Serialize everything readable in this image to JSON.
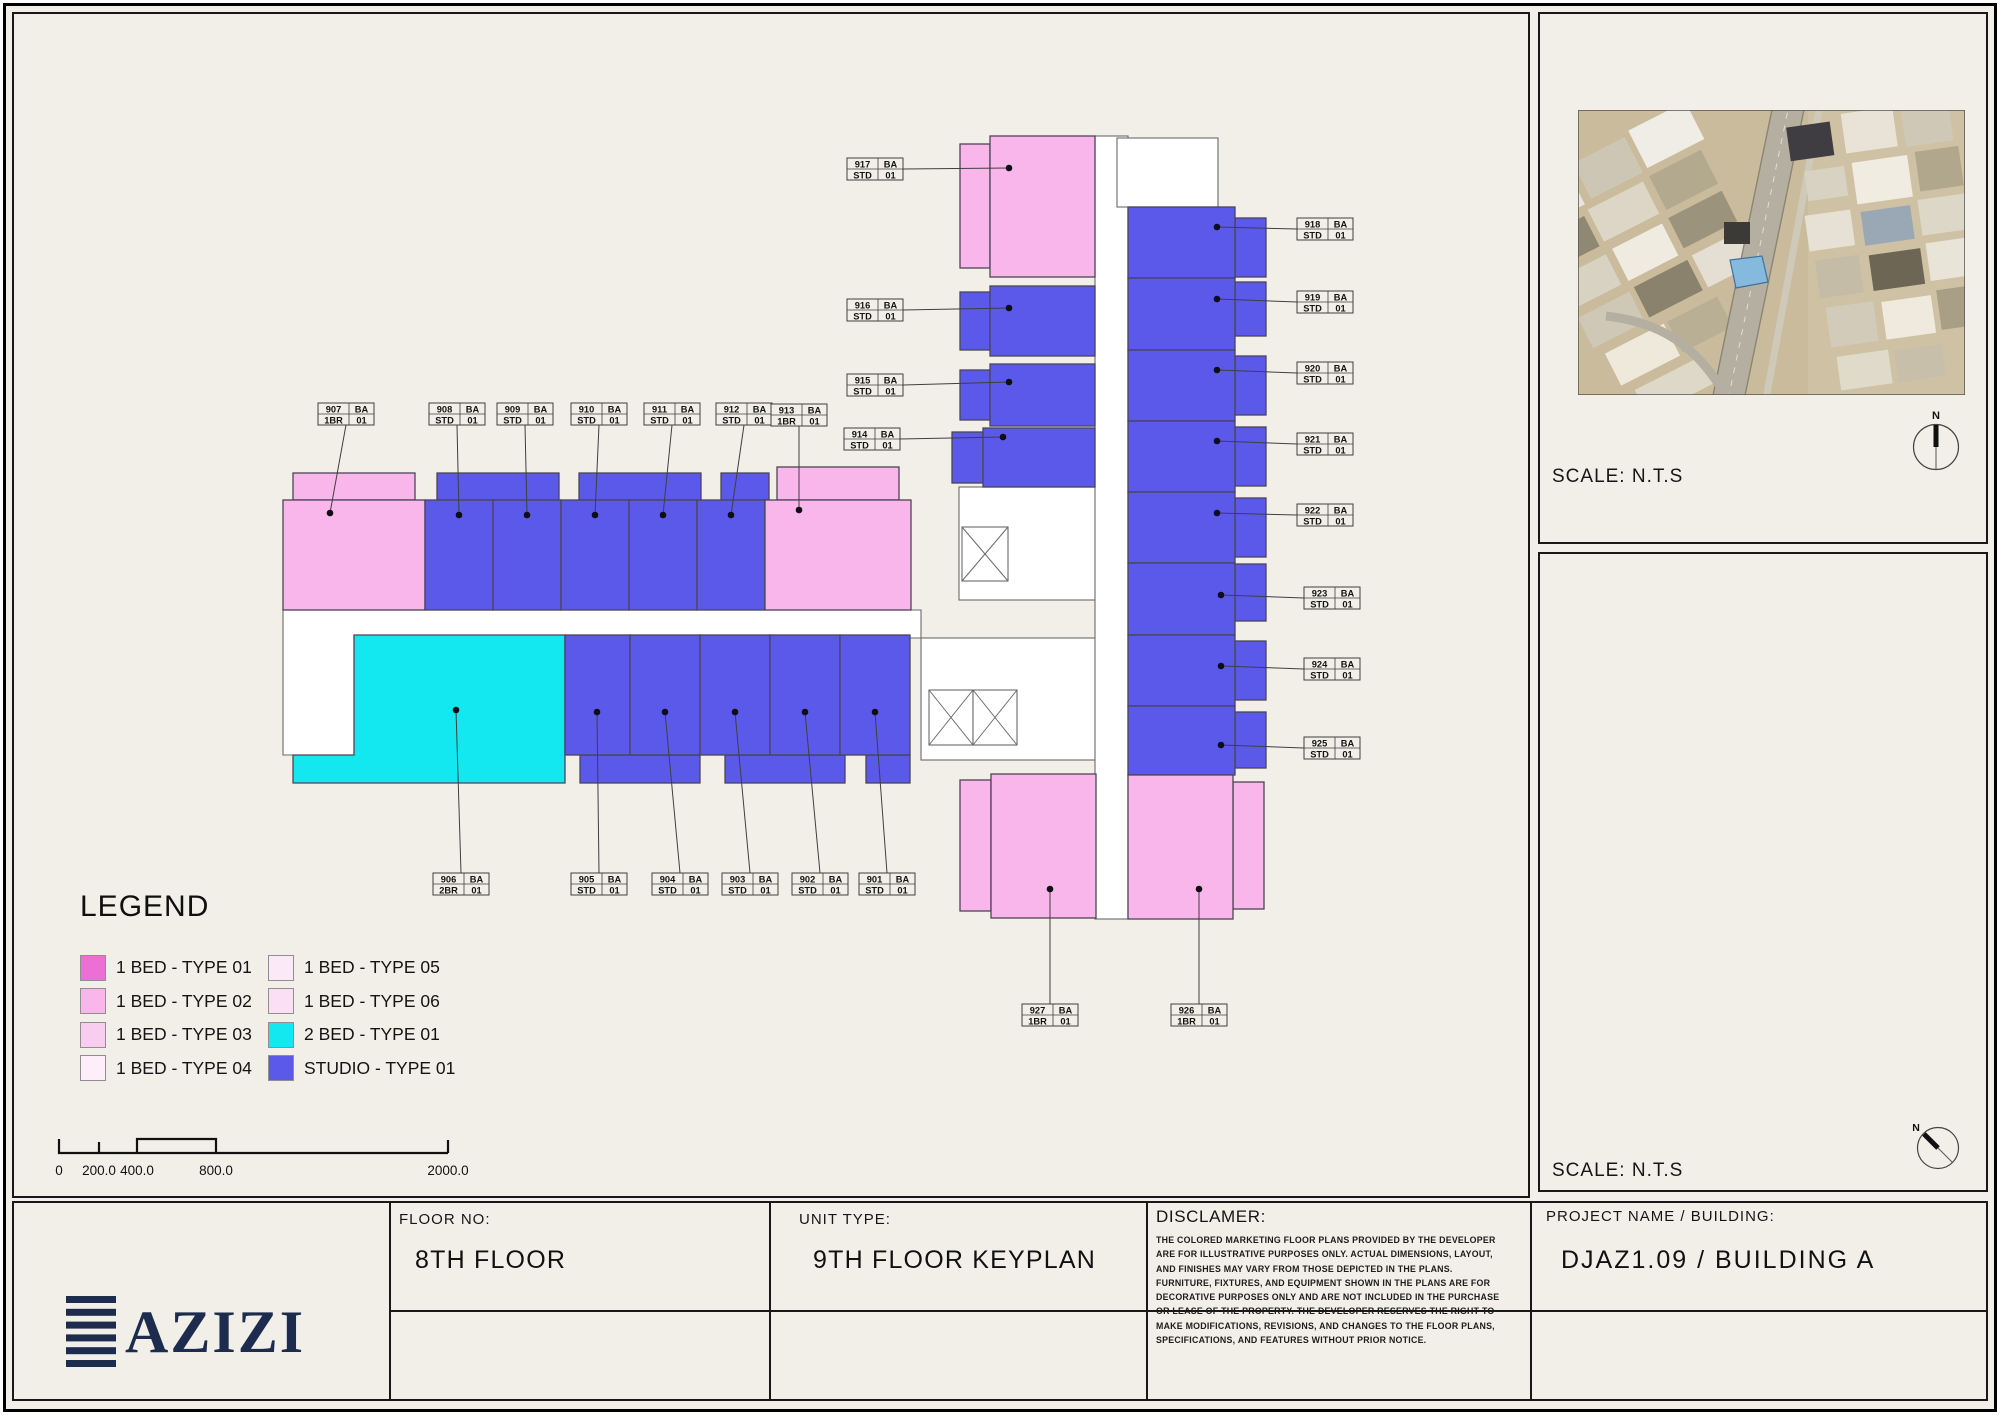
{
  "colors": {
    "pink": "#f9b6ea",
    "blue": "#5b59e9",
    "cyan": "#13e7f0",
    "navy": "#1c2b4e"
  },
  "legend": {
    "title": "LEGEND",
    "items": [
      {
        "label": "1 BED - TYPE 01",
        "color": "#ec6fd6"
      },
      {
        "label": "1 BED - TYPE 02",
        "color": "#f9b6ea"
      },
      {
        "label": "1 BED - TYPE 03",
        "color": "#f9cdef"
      },
      {
        "label": "1 BED - TYPE 04",
        "color": "#fdeefa"
      },
      {
        "label": "1 BED - TYPE 05",
        "color": "#fce9f8"
      },
      {
        "label": "1 BED - TYPE 06",
        "color": "#fbdff4"
      },
      {
        "label": "2 BED - TYPE 01",
        "color": "#13e7f0"
      },
      {
        "label": "STUDIO - TYPE 01",
        "color": "#5b59e9"
      }
    ]
  },
  "plan": {
    "units": [
      {
        "num": "901",
        "ba": "BA",
        "type": "STD",
        "idx": "01",
        "lx": 859,
        "ly": 873,
        "dx": 875,
        "dy": 712,
        "side": "top"
      },
      {
        "num": "902",
        "ba": "BA",
        "type": "STD",
        "idx": "01",
        "lx": 792,
        "ly": 873,
        "dx": 805,
        "dy": 712,
        "side": "top"
      },
      {
        "num": "903",
        "ba": "BA",
        "type": "STD",
        "idx": "01",
        "lx": 722,
        "ly": 873,
        "dx": 735,
        "dy": 712,
        "side": "top"
      },
      {
        "num": "904",
        "ba": "BA",
        "type": "STD",
        "idx": "01",
        "lx": 652,
        "ly": 873,
        "dx": 665,
        "dy": 712,
        "side": "top"
      },
      {
        "num": "905",
        "ba": "BA",
        "type": "STD",
        "idx": "01",
        "lx": 571,
        "ly": 873,
        "dx": 597,
        "dy": 712,
        "side": "top"
      },
      {
        "num": "906",
        "ba": "BA",
        "type": "2BR",
        "idx": "01",
        "lx": 433,
        "ly": 873,
        "dx": 456,
        "dy": 710,
        "side": "top"
      },
      {
        "num": "907",
        "ba": "BA",
        "type": "1BR",
        "idx": "01",
        "lx": 318,
        "ly": 403,
        "dx": 330,
        "dy": 513,
        "side": "bottom"
      },
      {
        "num": "908",
        "ba": "BA",
        "type": "STD",
        "idx": "01",
        "lx": 429,
        "ly": 403,
        "dx": 459,
        "dy": 515,
        "side": "bottom"
      },
      {
        "num": "909",
        "ba": "BA",
        "type": "STD",
        "idx": "01",
        "lx": 497,
        "ly": 403,
        "dx": 527,
        "dy": 515,
        "side": "bottom"
      },
      {
        "num": "910",
        "ba": "BA",
        "type": "STD",
        "idx": "01",
        "lx": 571,
        "ly": 403,
        "dx": 595,
        "dy": 515,
        "side": "bottom"
      },
      {
        "num": "911",
        "ba": "BA",
        "type": "STD",
        "idx": "01",
        "lx": 644,
        "ly": 403,
        "dx": 663,
        "dy": 515,
        "side": "bottom"
      },
      {
        "num": "912",
        "ba": "BA",
        "type": "STD",
        "idx": "01",
        "lx": 716,
        "ly": 403,
        "dx": 731,
        "dy": 515,
        "side": "bottom"
      },
      {
        "num": "913",
        "ba": "BA",
        "type": "1BR",
        "idx": "01",
        "lx": 771,
        "ly": 404,
        "dx": 799,
        "dy": 510,
        "side": "bottom"
      },
      {
        "num": "914",
        "ba": "BA",
        "type": "STD",
        "idx": "01",
        "lx": 844,
        "ly": 428,
        "dx": 1003,
        "dy": 437,
        "side": "right"
      },
      {
        "num": "915",
        "ba": "BA",
        "type": "STD",
        "idx": "01",
        "lx": 847,
        "ly": 374,
        "dx": 1009,
        "dy": 382,
        "side": "right"
      },
      {
        "num": "916",
        "ba": "BA",
        "type": "STD",
        "idx": "01",
        "lx": 847,
        "ly": 299,
        "dx": 1009,
        "dy": 308,
        "side": "right"
      },
      {
        "num": "917",
        "ba": "BA",
        "type": "STD",
        "idx": "01",
        "lx": 847,
        "ly": 158,
        "dx": 1009,
        "dy": 168,
        "side": "right"
      },
      {
        "num": "918",
        "ba": "BA",
        "type": "STD",
        "idx": "01",
        "lx": 1297,
        "ly": 218,
        "dx": 1217,
        "dy": 227,
        "side": "left"
      },
      {
        "num": "919",
        "ba": "BA",
        "type": "STD",
        "idx": "01",
        "lx": 1297,
        "ly": 291,
        "dx": 1217,
        "dy": 299,
        "side": "left"
      },
      {
        "num": "920",
        "ba": "BA",
        "type": "STD",
        "idx": "01",
        "lx": 1297,
        "ly": 362,
        "dx": 1217,
        "dy": 370,
        "side": "left"
      },
      {
        "num": "921",
        "ba": "BA",
        "type": "STD",
        "idx": "01",
        "lx": 1297,
        "ly": 433,
        "dx": 1217,
        "dy": 441,
        "side": "left"
      },
      {
        "num": "922",
        "ba": "BA",
        "type": "STD",
        "idx": "01",
        "lx": 1297,
        "ly": 504,
        "dx": 1217,
        "dy": 513,
        "side": "left"
      },
      {
        "num": "923",
        "ba": "BA",
        "type": "STD",
        "idx": "01",
        "lx": 1304,
        "ly": 587,
        "dx": 1221,
        "dy": 595,
        "side": "left"
      },
      {
        "num": "924",
        "ba": "BA",
        "type": "STD",
        "idx": "01",
        "lx": 1304,
        "ly": 658,
        "dx": 1221,
        "dy": 666,
        "side": "left"
      },
      {
        "num": "925",
        "ba": "BA",
        "type": "STD",
        "idx": "01",
        "lx": 1304,
        "ly": 737,
        "dx": 1221,
        "dy": 745,
        "side": "left"
      },
      {
        "num": "926",
        "ba": "BA",
        "type": "1BR",
        "idx": "01",
        "lx": 1171,
        "ly": 1004,
        "dx": 1199,
        "dy": 889,
        "side": "top"
      },
      {
        "num": "927",
        "ba": "BA",
        "type": "1BR",
        "idx": "01",
        "lx": 1022,
        "ly": 1004,
        "dx": 1050,
        "dy": 889,
        "side": "top"
      }
    ]
  },
  "scale_bar": {
    "labels": [
      {
        "text": "0",
        "x": 59
      },
      {
        "text": "200.0",
        "x": 99
      },
      {
        "text": "400.0",
        "x": 137
      },
      {
        "text": "800.0",
        "x": 216
      },
      {
        "text": "2000.0",
        "x": 448
      }
    ]
  },
  "panels": {
    "site_scale": "SCALE: N.T.S",
    "key_scale": "SCALE: N.T.S",
    "north": "N"
  },
  "title_block": {
    "brand": "AZIZI",
    "floor_no_label": "FLOOR NO:",
    "floor_no": "8TH FLOOR",
    "unit_type_label": "UNIT TYPE:",
    "unit_type": "9TH FLOOR KEYPLAN",
    "disclaimer_label": "DISCLAMER:",
    "disclaimer_text": "THE COLORED MARKETING FLOOR PLANS PROVIDED BY THE DEVELOPER ARE FOR ILLUSTRATIVE PURPOSES ONLY. ACTUAL DIMENSIONS, LAYOUT, AND FINISHES MAY VARY FROM THOSE DEPICTED IN THE PLANS. FURNITURE, FIXTURES, AND EQUIPMENT SHOWN IN THE PLANS ARE FOR DECORATIVE PURPOSES ONLY AND ARE NOT INCLUDED IN THE PURCHASE OR LEASE OF THE PROPERTY. THE DEVELOPER RESERVES THE RIGHT TO MAKE MODIFICATIONS, REVISIONS, AND CHANGES TO THE FLOOR PLANS, SPECIFICATIONS, AND FEATURES WITHOUT PRIOR NOTICE.",
    "project_label": "PROJECT NAME / BUILDING:",
    "project_name": "DJAZ1.09 / BUILDING A"
  }
}
